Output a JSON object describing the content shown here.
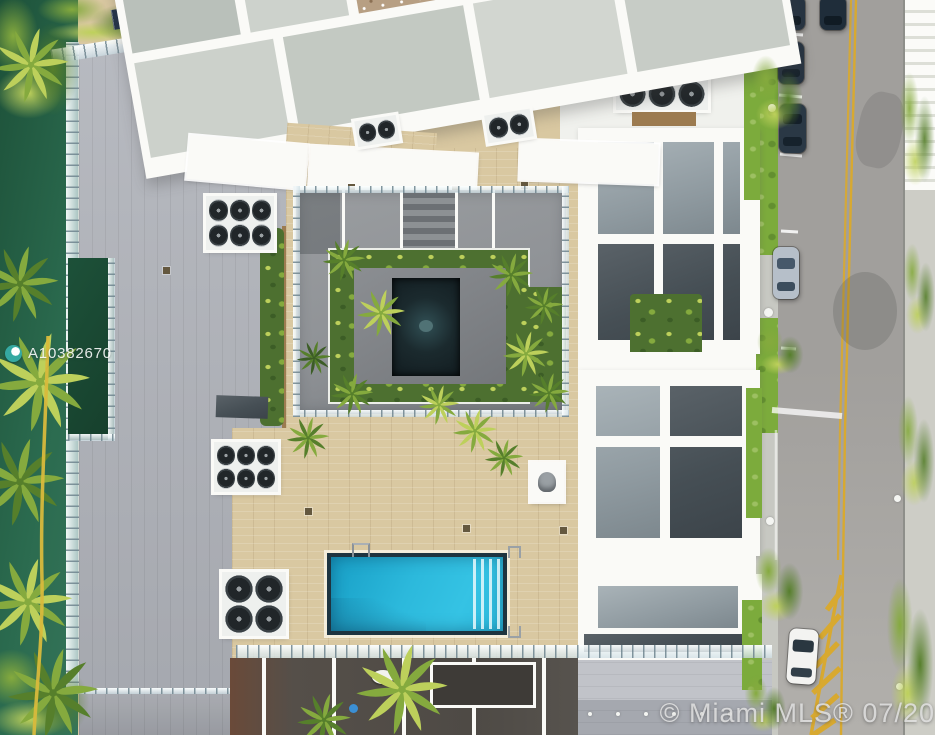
{
  "image": {
    "type": "aerial-drone-photo",
    "description": "Overhead aerial view of a modern white condo building rooftop amenity deck: central sunken courtyard garden with dark reflecting pond and palms, beige paver pool deck with rectangular blue swimming pool, gray rooftop terraces with AC equipment wells, angled white pergola grid structures, waterfront canal with palm trees on the left, and a street with double yellow center line, hatched no-parking zone and parked cars on the right.",
    "width_px": 935,
    "height_px": 735
  },
  "watermarks": {
    "listing_id": "A10382670",
    "mls_credit": "© Miami MLS® 07/201"
  },
  "colors": {
    "water": "#2b6b4f",
    "water-dark": "#1d5139",
    "palm-light": "#bdd05b",
    "palm-mid": "#85aa3e",
    "palm-dark": "#567f2b",
    "canopy-dark": "#3c5d26",
    "roof": "#afb2b9",
    "roof-light": "#c1c3c9",
    "roof-dark": "#989ba2",
    "white": "#f0f1ed",
    "white-bright": "#fafaf7",
    "panel-gray": "#b9c0ba",
    "panel-gray-light": "#cdd2cc",
    "panel-dark": "#464f55",
    "glass-gray": "#a9b3b8",
    "deck": "#d9c8a1",
    "deck-shade": "#c9b68c",
    "concrete": "#8f9296",
    "concrete-dark": "#75797d",
    "pond": "#1b2a2e",
    "pool-blue": "#2cb9dc",
    "pool-deep": "#189fc6",
    "pool-rim": "#1e3440",
    "rail-glass": "#dfe9ec",
    "planter-wood": "#9c7b50",
    "asphalt": "#a19f9c",
    "asphalt-light": "#b2b0ac",
    "lane-yellow": "#d8a930",
    "grass": "#7cab3c",
    "sidewalk": "#cdcdc6",
    "car-dark": "#273442",
    "car-silver": "#b6bfc9",
    "car-white": "#f3f3f1",
    "watermark": "#e3e3e3"
  }
}
